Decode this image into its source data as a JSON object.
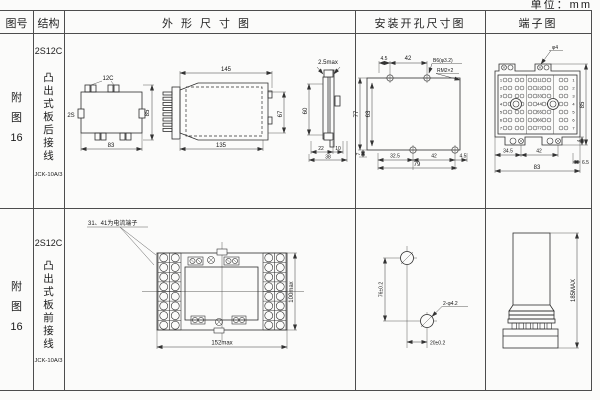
{
  "unit_note": "单位：mm",
  "headers": {
    "fig_no": "图号",
    "structure": "结构",
    "outline": "外形尺寸图",
    "install": "安装开孔尺寸图",
    "terminal": "端子图"
  },
  "row1": {
    "fig_label": [
      "附",
      "图",
      "16"
    ],
    "structure": {
      "model": "2S12C",
      "mount": "凸出式板后接线",
      "relay": "JCK-10A/3"
    },
    "outline": {
      "front": {
        "top_label": "12C",
        "side_label": "2S",
        "height": "85",
        "width": "83"
      },
      "side": {
        "width_top": "145",
        "width_bottom": "135",
        "height": "67"
      },
      "panel": {
        "thickness": "2.5max",
        "height": "60",
        "d22": "22",
        "d10": "10",
        "d38": "38"
      }
    },
    "install": {
      "top_offset": "4.5",
      "top_span": "42",
      "hole_note": "B6(φ3.2)",
      "thread_note": "RM2×2",
      "height_outer": "77",
      "height_inner": "63",
      "bottom_offset": "7",
      "b1": "32.5",
      "b2": "42",
      "b3": "4.5",
      "width": "79"
    },
    "terminal": {
      "screw_note": "φ4",
      "b1": "34.5",
      "b2": "42",
      "b3": "6.5",
      "width": "83",
      "height": "85",
      "side": "4",
      "rows": [
        "1",
        "2",
        "3",
        "4",
        "5",
        "6",
        "7"
      ],
      "pairs": [
        "11",
        "22",
        "33",
        "44",
        "55",
        "66",
        "77"
      ]
    }
  },
  "row2": {
    "fig_label": [
      "附",
      "图",
      "16"
    ],
    "structure": {
      "model": "2S12C",
      "mount": "凸出式板前接线",
      "relay": "JCK-10A/3"
    },
    "outline": {
      "note": "31、41为电流端子",
      "width": "152max",
      "height": "100max"
    },
    "install": {
      "v": "76±0.2",
      "h": "20±0.2",
      "holes": "2-φ4.2"
    },
    "terminal": {
      "height": "185MAX"
    }
  }
}
